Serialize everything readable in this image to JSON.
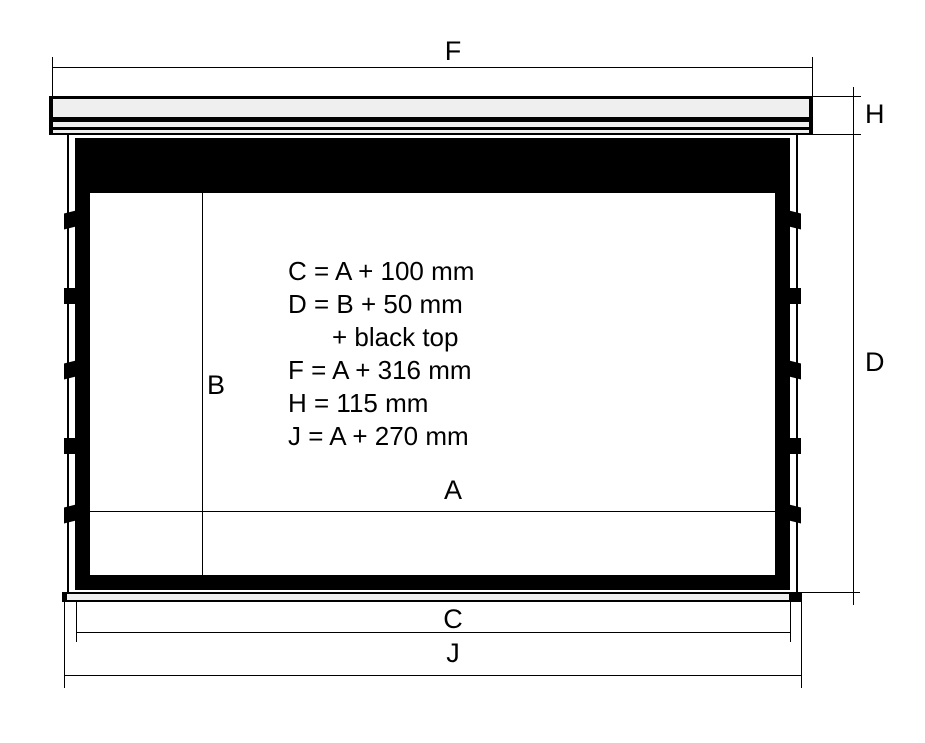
{
  "diagram": {
    "dim_labels": {
      "f": "F",
      "h": "H",
      "d": "D",
      "b": "B",
      "a": "A",
      "c": "C",
      "j": "J"
    },
    "formulas": [
      "C = A + 100 mm",
      "D = B + 50 mm",
      "+ black top",
      "F = A + 316 mm",
      "H = 115 mm",
      "J = A + 270 mm"
    ],
    "colors": {
      "line": "#000000",
      "casing_fill": "#efefef",
      "slat_fill": "#efefef",
      "frame": "#000000",
      "screen": "#ffffff",
      "background": "#ffffff"
    }
  }
}
